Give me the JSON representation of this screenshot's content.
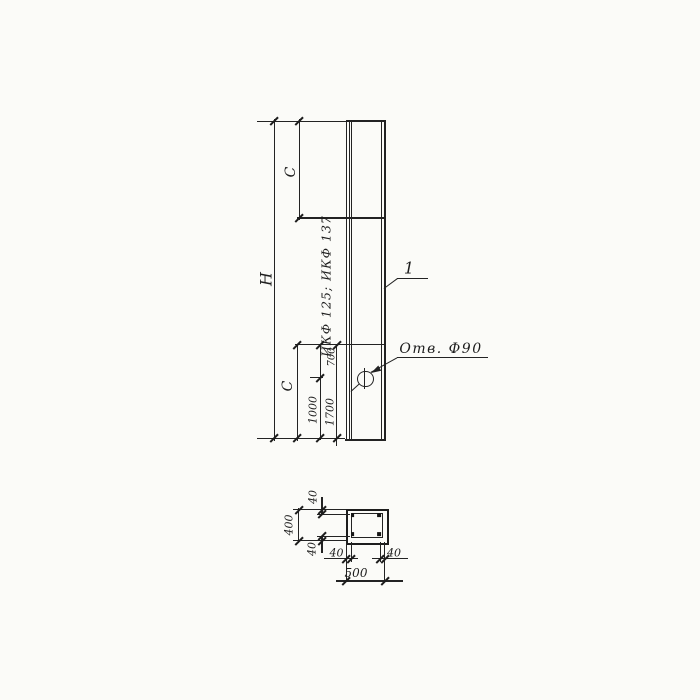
{
  "drawing": {
    "type": "technical-drawing",
    "views": [
      "elevation",
      "cross-section"
    ],
    "colors": {
      "ink": "#232323",
      "paper": "#fbfbf8"
    },
    "elevation": {
      "dim_overall_height": "H",
      "dim_top_segment": "С",
      "dim_bottom_segment": "С",
      "dim_hole_offset_from_joint": "700",
      "dim_hole_from_bottom": "1000",
      "dim_joint_from_bottom": "1700",
      "series_note": "ИКФ 125; ИКФ 137",
      "hole_note": "Отв. Ф90",
      "callout_number": "1"
    },
    "section": {
      "dim_total_width": "500",
      "dim_total_height": "400",
      "dim_cover_top": "40",
      "dim_cover_bottom": "40",
      "dim_cover_left": "40",
      "dim_cover_right": "40"
    }
  }
}
